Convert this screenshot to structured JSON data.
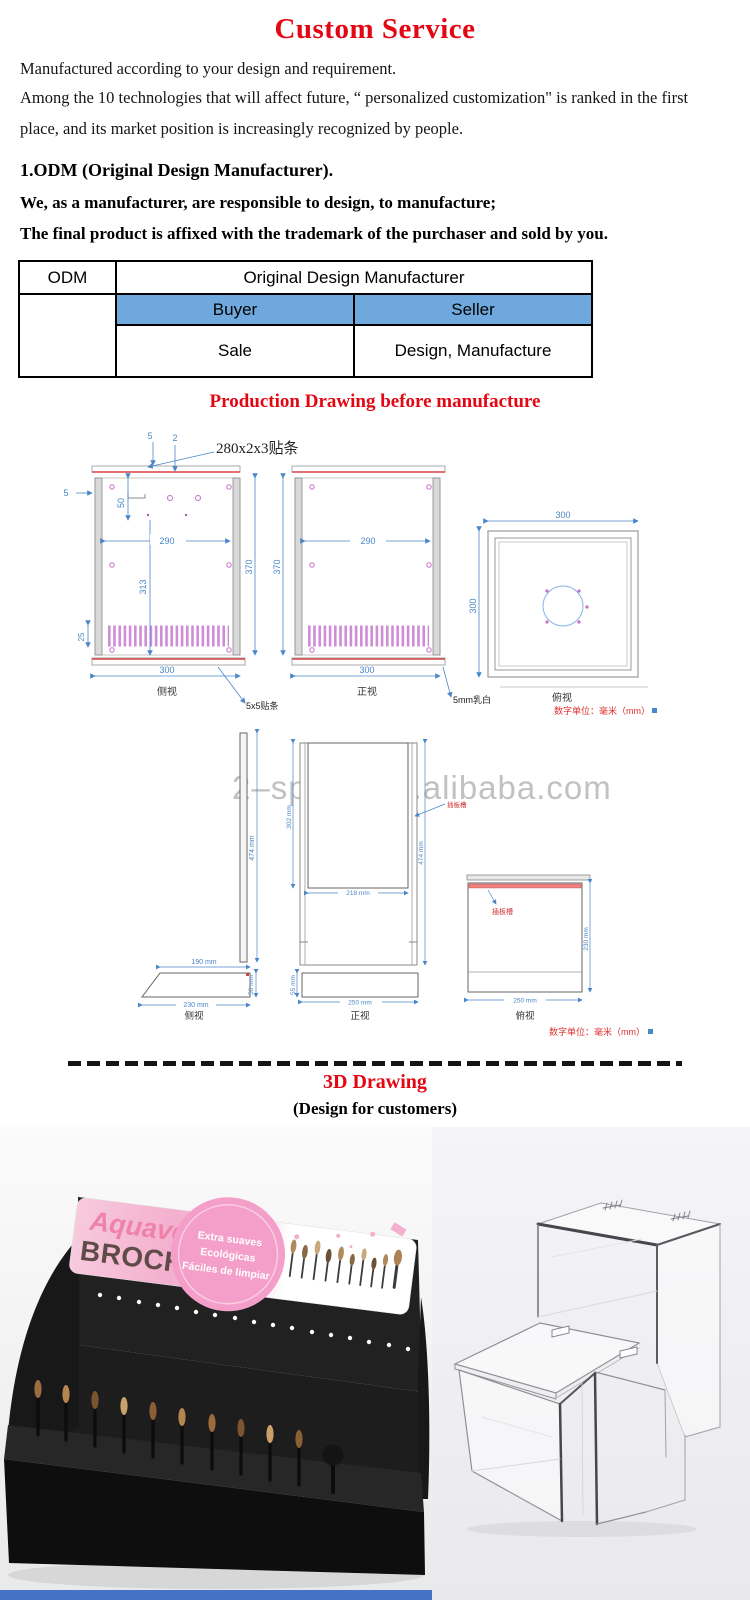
{
  "title": "Custom Service",
  "intro": {
    "p1": "Manufactured according to your design and requirement.",
    "p2a": "Among the 10 technologies that will affect future, “ personalized customization\" is ranked in the first",
    "p2b": "place, and its market position is increasingly recognized by people."
  },
  "odm": {
    "heading": "1.ODM (Original Design Manufacturer).",
    "line1": "We, as a manufacturer, are responsible to design, to manufacture;",
    "line2": "The final product is affixed with the trademark of the purchaser and sold by you."
  },
  "table": {
    "r1c1": "ODM",
    "r1c2": "Original Design Manufacturer",
    "r2c1": "Buyer",
    "r2c2": "Seller",
    "r3c1": "Sale",
    "r3c2": "Design, Manufacture"
  },
  "drawing1": {
    "heading": "Production Drawing before manufacture",
    "note_strip": "280x2x3贴条",
    "note_tape": "5x5贴条",
    "note_acrylic": "5mm乳白",
    "dim_5": "5",
    "dim_2": "2",
    "dim_50": "50",
    "dim_25": "25",
    "dim_290": "290",
    "dim_313": "313",
    "dim_370": "370",
    "dim_300": "300",
    "label_side": "侧视",
    "label_front": "正视",
    "label_top": "俯视",
    "unit_note": "数字单位：毫米（mm）"
  },
  "drawing2": {
    "watermark": "2–space.en.alibaba.com",
    "dim_474": "474 mm",
    "dim_302": "302 mm",
    "dim_218": "218 mm",
    "dim_190": "190 mm",
    "dim_230": "230 mm",
    "dim_50": "50 mm",
    "dim_55": "55 mm",
    "dim_250": "250 mm",
    "note_slot": "插板槽",
    "label_side": "侧视",
    "label_front": "正视",
    "label_top": "俯视",
    "unit_note": "数字单位：毫米（mm）"
  },
  "section3d": {
    "heading": "3D Drawing",
    "subheading": "(Design for customers)"
  },
  "display_stand": {
    "brand": "Aquavera",
    "product": "BROCHAS",
    "badge": [
      "Extra suaves",
      "Ecológicas",
      "Fáciles de limpiar"
    ]
  },
  "colors": {
    "accent_red": "#e30613",
    "table_header_blue": "#6fa8dc",
    "dim_blue": "#4a86c8",
    "slot_pink": "#c77ad1",
    "strip_red": "#d94444",
    "bottom_bar_blue": "#4472c4"
  }
}
